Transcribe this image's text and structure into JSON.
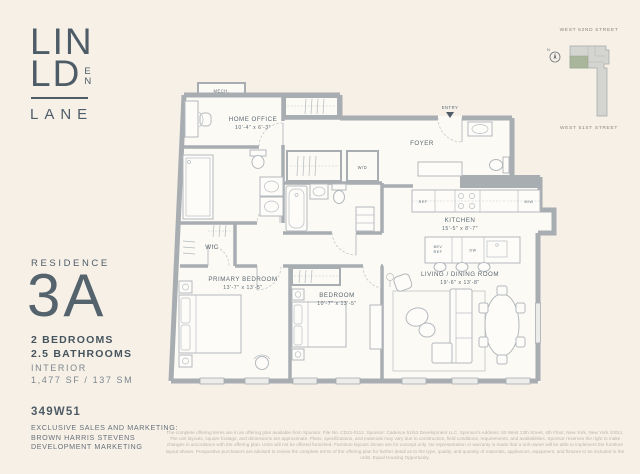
{
  "logo": {
    "line1": "LIN",
    "line2": "LD",
    "e": "E",
    "n": "N",
    "line3": "LANE"
  },
  "keyplan": {
    "street_top": "WEST 52ND STREET",
    "street_bottom": "WEST 51ST STREET",
    "compass": "N"
  },
  "residence": {
    "label": "RESIDENCE",
    "unit": "3A",
    "bedrooms": "2 BEDROOMS",
    "bathrooms": "2.5 BATHROOMS",
    "interior_label": "INTERIOR",
    "area": "1,477 SF / 137 SM"
  },
  "building": {
    "address": "349W51"
  },
  "marketing": {
    "line1": "EXCLUSIVE SALES AND MARKETING:",
    "line2": "BROWN HARRIS STEVENS",
    "line3": "DEVELOPMENT MARKETING"
  },
  "disclaimer": "The complete offering terms are in an offering plan available from Sponsor. File No. CD21-0112. Sponsor: Cadence 51/53 Development LLC. Sponsor's Address: 60 West 13th Street, 4th Floor, New York, New York 10011. The unit layouts, square footage, and dimensions are approximate. Plans, specifications, and materials may vary due to construction, field conditions, requirements, and availabilities. Sponsor reserves the right to make changes in accordance with the offering plan. Units will not be offered furnished. Furniture layouts shown are for concept only. No representation or warranty is made that a unit owner will be able to implement the furniture layout shown. Prospective purchasers are advised to review the complete terms of the offering plan for further detail as to the type, quality, and quantity of materials, appliances, equipment, and fixtures to be included in the units. Equal Housing Opportunity.",
  "floorplan": {
    "mech": "MECH.",
    "home_office": {
      "name": "HOME OFFICE",
      "dims": "10'-4\" x 6'-3\""
    },
    "entry": "ENTRY",
    "foyer": "FOYER",
    "wd": "W/D",
    "wic": "WIC",
    "kitchen": {
      "name": "KITCHEN",
      "dims": "15'-5\" x 8'-7\""
    },
    "appliances": {
      "ref": "REF",
      "dw": "DW",
      "mw": "M/W",
      "bev": "BEV",
      "bev_ref": "REF"
    },
    "primary_bedroom": {
      "name": "PRIMARY BEDROOM",
      "dims": "13'-7\" x 13'-5\""
    },
    "bedroom": {
      "name": "BEDROOM",
      "dims": "10'-7\" x 13'-5\""
    },
    "living": {
      "name": "LIVING / DINING ROOM",
      "dims": "19'-6\" x 13'-8\""
    }
  }
}
